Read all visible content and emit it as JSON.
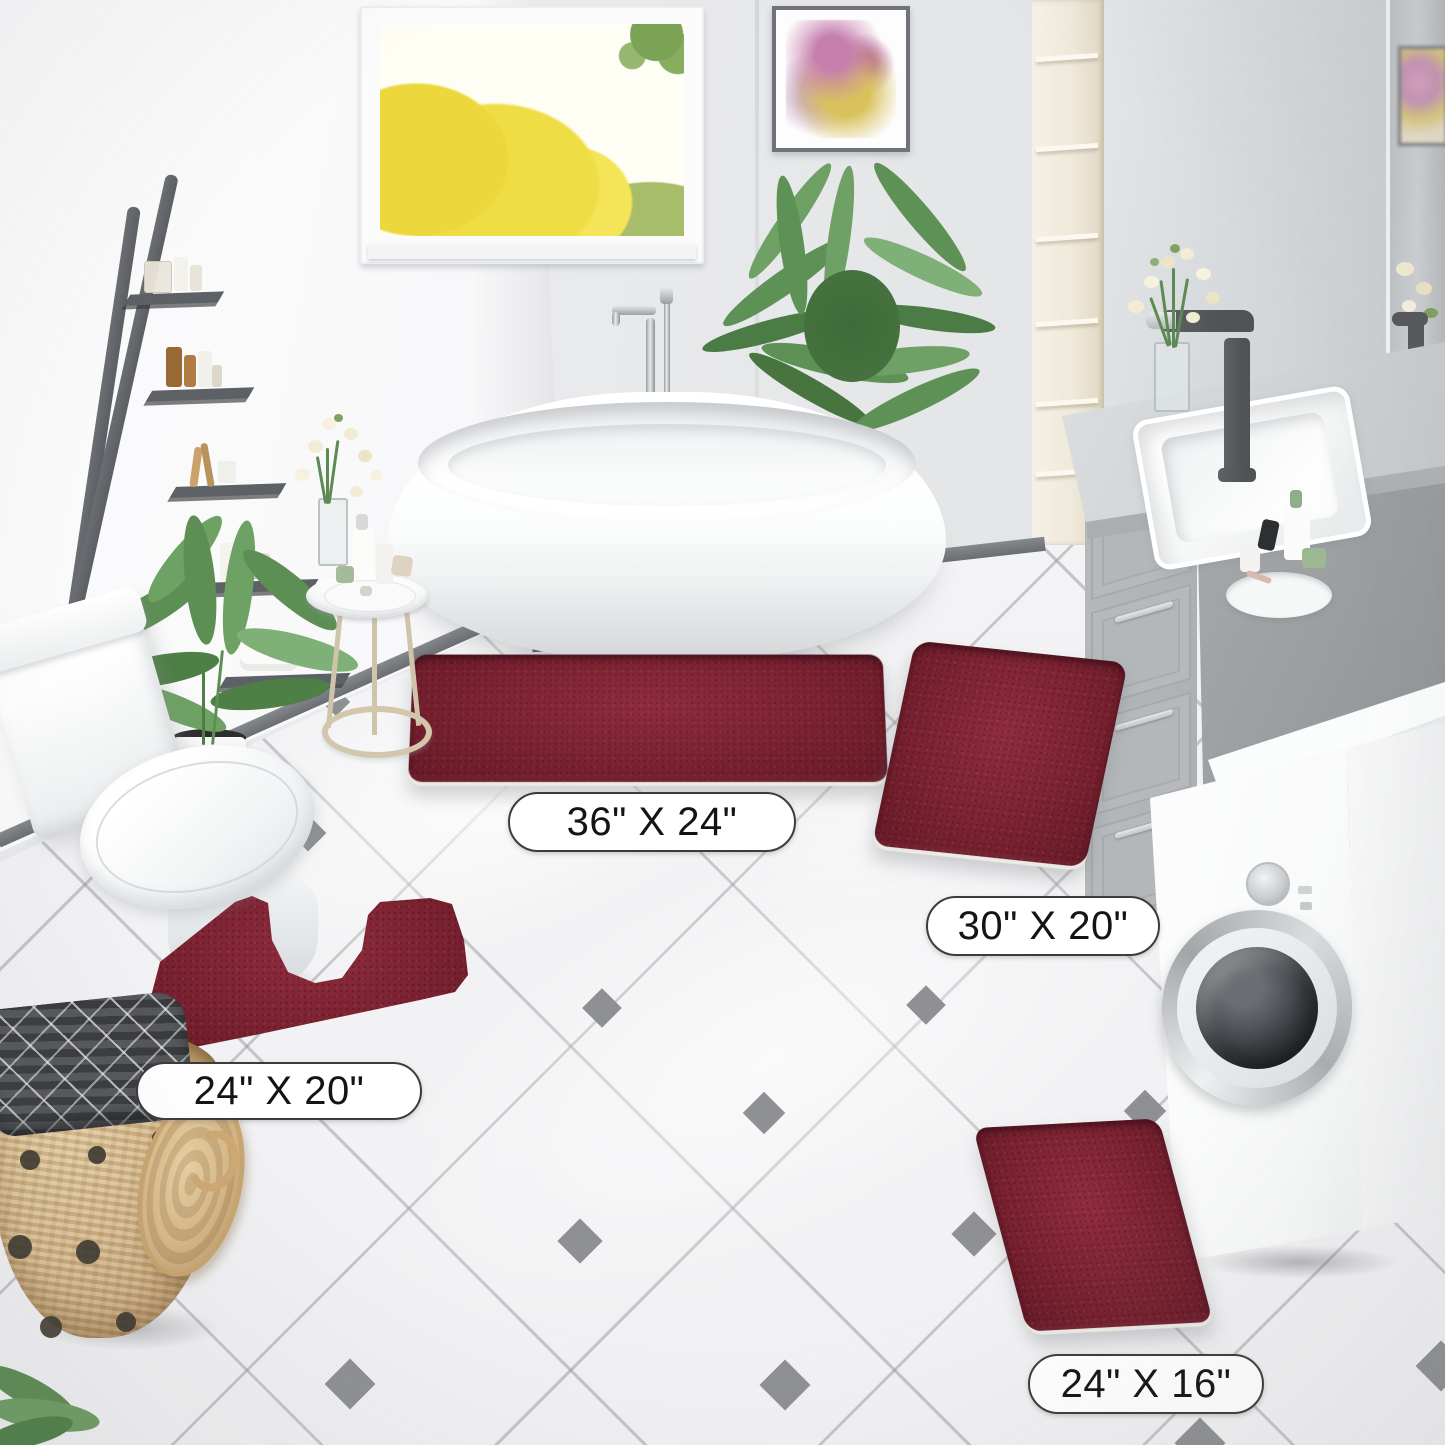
{
  "image": {
    "type": "product-photo",
    "subject": "Burgundy chenille bathroom rug set shown in four sizes, staged on white diagonal tile in a modern bathroom",
    "width_px": 1445,
    "height_px": 1445
  },
  "rugs": [
    {
      "id": "rug-36x24",
      "size_label": "36\" X 24\"",
      "shape": "rectangle"
    },
    {
      "id": "rug-30x20",
      "size_label": "30\" X 20\"",
      "shape": "rectangle"
    },
    {
      "id": "rug-24x20",
      "size_label": "24\" X 20\"",
      "shape": "u-shaped-contour"
    },
    {
      "id": "rug-24x16",
      "size_label": "24\" X 16\"",
      "shape": "rectangle"
    }
  ],
  "scene_objects": [
    "freestanding-bathtub",
    "floor-mounted-chrome-faucet",
    "window-autumn-trees-view",
    "framed-abstract-artwork",
    "ladder-shelf-with-toiletries",
    "palm-plant",
    "potted-plant",
    "toilet",
    "side-table-with-toiletries",
    "flower-vase",
    "tall-cream-shelf",
    "vanity-with-sink-and-dark-faucet",
    "vanity-mirror",
    "toiletries-tray",
    "washing-machine",
    "wicker-basket-with-laundry",
    "white-diagonal-tile-floor"
  ],
  "colors": {
    "rug": "#7b2231",
    "rug_light": "#8e2c3d",
    "rug_dark": "#671a28",
    "fringe": "#eeebe5",
    "label_bg": "#ffffff",
    "label_border": "#3c3c3c",
    "label_text": "#141414",
    "floor": "#f1f1f3",
    "grout": "#a9abaf",
    "diamond": "#8e9093",
    "wall_left": "#f7f7f9",
    "wall_back": "#e9eaec",
    "mirror_gray": "#cdd0d3",
    "baseboard": "#6a6d71",
    "ladder": "#5b5e62",
    "cream_shelf": "#efe9da",
    "counter": "#ced1d3",
    "cabinet": "#b4b7ba",
    "cabinet_side": "#9b9ea1",
    "washer": "#f8f9f9",
    "faucet_dark": "#505356",
    "tub_white": "#ffffff",
    "plant": "#5f9156",
    "plant_dark": "#47743f",
    "basket": "#d7b88a",
    "basket_dot": "#3a362e",
    "autumn_yellow": "#eedd45",
    "window_green": "#7ba355",
    "art_pink": "#c77fae",
    "art_gold": "#d9c25e"
  }
}
